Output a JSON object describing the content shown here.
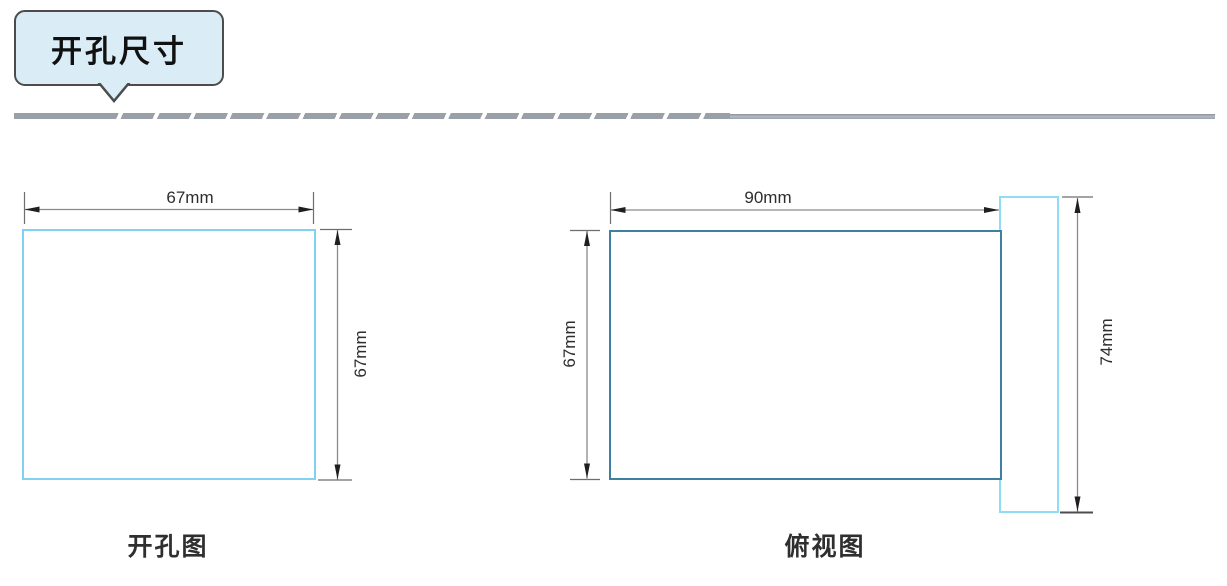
{
  "header": {
    "title": "开孔尺寸"
  },
  "diagrams": {
    "cutout": {
      "caption": "开孔图",
      "width_label": "67mm",
      "height_label": "67mm"
    },
    "top_view": {
      "caption": "俯视图",
      "width_label": "90mm",
      "body_height_label": "67mm",
      "overall_height_label": "74mm"
    }
  },
  "colors": {
    "bubble_fill": "#daedf7",
    "bubble_border": "#4c4c4c",
    "divider_gray": "#9aa0a7",
    "cutout_outline": "#7fd2f2",
    "panel_body_outline": "#3d80a0",
    "panel_flange_outline": "#90dcf6",
    "dimension_line": "#8a8a8a",
    "arrow": "#1f1f1f",
    "text": "#2d2d2d"
  }
}
